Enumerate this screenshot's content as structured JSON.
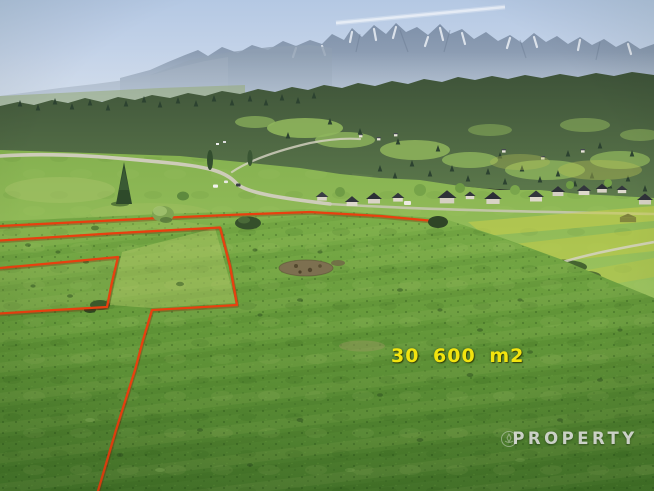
{
  "photo": {
    "aria_label": "Aerial photo of green meadows with a building plot outlined in red, chalet village and Tatra mountain panorama in the background",
    "area_label": "30 600 m2",
    "watermark_text": "PROPERTY",
    "colors": {
      "boundary_red": "#e8400f",
      "area_label_yellow": "#f2e40e",
      "watermark_gray": "#ebebeb"
    }
  }
}
